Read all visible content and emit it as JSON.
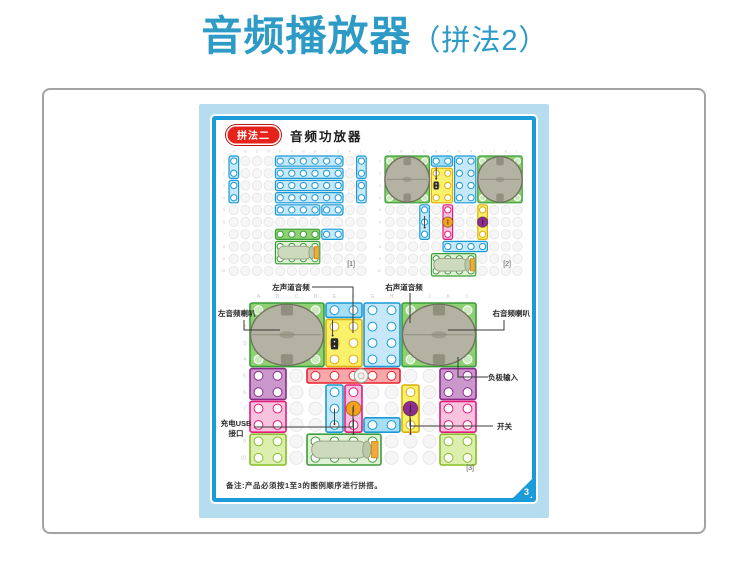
{
  "header": {
    "title_main": "音频播放器",
    "title_sub": "（拼法2）"
  },
  "page": {
    "badge": "拼法二",
    "title": "音频功放器",
    "note": "备注:产品必须按1至3的图例顺序进行拼搭。",
    "page_number": "3"
  },
  "labels": {
    "left_channel": "左声道音频",
    "right_channel": "右声道音频",
    "left_speaker": "左音频喇叭",
    "right_speaker": "右音频喇叭",
    "negative_input": "负极输入",
    "usb_line1": "充电USB",
    "usb_line2": "接口",
    "switch": "开关"
  },
  "grid_letters": [
    "A",
    "B",
    "C",
    "D",
    "E",
    "F",
    "G",
    "H",
    "I",
    "J",
    "K",
    "L"
  ],
  "grid_numbers": [
    "1",
    "2",
    "3",
    "4",
    "5",
    "6",
    "7",
    "8",
    "9",
    "10"
  ],
  "colors": {
    "title_blue": "#2e9bc6",
    "page_border_blue": "#1b9cd9",
    "page_bg_blue": "#b6dcf0",
    "badge_red": "#e5231b",
    "knob_orange": "#f2a21b",
    "knob_purple": "#8e2d8e"
  },
  "palette": {
    "blue": {
      "f": "#c7e8f8",
      "s": "#1a9ad6"
    },
    "cyan": {
      "f": "#a6def4",
      "s": "#1a9ad6"
    },
    "green": {
      "f": "#8ed072",
      "s": "#3a9e3a"
    },
    "battery": {
      "f": "#e2f1d5",
      "s": "#3a9e3a"
    },
    "lgreen": {
      "f": "#dcefae",
      "s": "#86bd28"
    },
    "yellow": {
      "f": "#f9f06c",
      "s": "#dfae0b"
    },
    "pink": {
      "f": "#f8c3dd",
      "s": "#e8197d"
    },
    "purple": {
      "f": "#cb98cb",
      "s": "#8d278d"
    },
    "red": {
      "f": "#f6a8ac",
      "s": "#e8242c"
    },
    "speaker": {
      "f": "#b3b2a3",
      "s": "#72725f"
    }
  },
  "figures": {
    "fig1": {
      "caption": "[1]",
      "bricks": [
        {
          "x": 0,
          "y": 0,
          "w": 1,
          "h": 2,
          "c": "blue"
        },
        {
          "x": 0,
          "y": 2,
          "w": 1,
          "h": 2,
          "c": "blue"
        },
        {
          "x": 4,
          "y": 0,
          "w": 6,
          "h": 1,
          "c": "blue"
        },
        {
          "x": 4,
          "y": 1,
          "w": 6,
          "h": 1,
          "c": "blue"
        },
        {
          "x": 4,
          "y": 2,
          "w": 6,
          "h": 1,
          "c": "blue"
        },
        {
          "x": 4,
          "y": 3,
          "w": 6,
          "h": 1,
          "c": "blue"
        },
        {
          "x": 4,
          "y": 4,
          "w": 4,
          "h": 1,
          "c": "blue"
        },
        {
          "x": 8,
          "y": 4,
          "w": 2,
          "h": 1,
          "c": "blue"
        },
        {
          "x": 11,
          "y": 0,
          "w": 1,
          "h": 2,
          "c": "blue"
        },
        {
          "x": 11,
          "y": 2,
          "w": 1,
          "h": 2,
          "c": "blue"
        },
        {
          "x": 4,
          "y": 6,
          "w": 4,
          "h": 1,
          "c": "green"
        },
        {
          "x": 8,
          "y": 6,
          "w": 2,
          "h": 1,
          "c": "blue"
        },
        {
          "x": 4,
          "y": 7,
          "w": 4,
          "h": 2,
          "c": "green",
          "type": "battery"
        }
      ],
      "decos": []
    },
    "fig2": {
      "caption": "[2]",
      "bricks": [
        {
          "x": 0,
          "y": 0,
          "w": 4,
          "h": 4,
          "c": "green",
          "type": "speaker"
        },
        {
          "x": 8,
          "y": 0,
          "w": 4,
          "h": 4,
          "c": "green",
          "type": "speaker"
        },
        {
          "x": 4,
          "y": 0,
          "w": 2,
          "h": 1,
          "c": "cyan"
        },
        {
          "x": 6,
          "y": 0,
          "w": 2,
          "h": 4,
          "c": "blue"
        },
        {
          "x": 4,
          "y": 1,
          "w": 2,
          "h": 3,
          "c": "yellow"
        },
        {
          "x": 3,
          "y": 4,
          "w": 1,
          "h": 3,
          "c": "blue"
        },
        {
          "x": 5,
          "y": 4,
          "w": 1,
          "h": 3,
          "c": "pink"
        },
        {
          "x": 5,
          "y": 7,
          "w": 4,
          "h": 1,
          "c": "blue"
        },
        {
          "x": 8,
          "y": 4,
          "w": 1,
          "h": 3,
          "c": "yellow"
        },
        {
          "x": 4,
          "y": 8,
          "w": 4,
          "h": 2,
          "c": "green",
          "type": "battery"
        }
      ],
      "decos": [
        {
          "type": "chip",
          "x": 4.5,
          "y": 2.5
        },
        {
          "type": "wire",
          "x": 4.5,
          "y": 1.5
        },
        {
          "type": "wire",
          "x": 3.5,
          "y": 5.5
        },
        {
          "type": "knob",
          "x": 5.5,
          "y": 5.5,
          "color": "#f2a21b"
        },
        {
          "type": "knob",
          "x": 8.5,
          "y": 5.5,
          "color": "#8e2d8e"
        }
      ]
    },
    "fig3": {
      "caption": "[3]",
      "bricks": [
        {
          "x": 0,
          "y": 0,
          "w": 4,
          "h": 4,
          "c": "green",
          "type": "speaker"
        },
        {
          "x": 8,
          "y": 0,
          "w": 4,
          "h": 4,
          "c": "green",
          "type": "speaker"
        },
        {
          "x": 4,
          "y": 0,
          "w": 2,
          "h": 1,
          "c": "cyan"
        },
        {
          "x": 6,
          "y": 0,
          "w": 2,
          "h": 4,
          "c": "blue"
        },
        {
          "x": 4,
          "y": 1,
          "w": 2,
          "h": 3,
          "c": "yellow"
        },
        {
          "x": 0,
          "y": 4,
          "w": 2,
          "h": 2,
          "c": "purple"
        },
        {
          "x": 10,
          "y": 4,
          "w": 2,
          "h": 2,
          "c": "purple"
        },
        {
          "x": 3,
          "y": 4,
          "w": 5,
          "h": 1,
          "c": "red"
        },
        {
          "x": 0,
          "y": 6,
          "w": 2,
          "h": 2,
          "c": "pink"
        },
        {
          "x": 10,
          "y": 6,
          "w": 2,
          "h": 2,
          "c": "pink"
        },
        {
          "x": 4,
          "y": 5,
          "w": 1,
          "h": 3,
          "c": "blue"
        },
        {
          "x": 5,
          "y": 5,
          "w": 1,
          "h": 3,
          "c": "pink"
        },
        {
          "x": 6,
          "y": 7,
          "w": 2,
          "h": 1,
          "c": "cyan"
        },
        {
          "x": 8,
          "y": 5,
          "w": 1,
          "h": 3,
          "c": "yellow"
        },
        {
          "x": 0,
          "y": 8,
          "w": 2,
          "h": 2,
          "c": "lgreen"
        },
        {
          "x": 10,
          "y": 8,
          "w": 2,
          "h": 2,
          "c": "lgreen"
        },
        {
          "x": 3,
          "y": 8,
          "w": 4,
          "h": 2,
          "c": "green",
          "type": "battery"
        }
      ],
      "decos": [
        {
          "type": "chip",
          "x": 4.5,
          "y": 2.55
        },
        {
          "type": "wire",
          "x": 4.4,
          "y": 1.6
        },
        {
          "type": "disc",
          "x": 5.9,
          "y": 4.5
        },
        {
          "type": "knob",
          "x": 5.5,
          "y": 6.5,
          "color": "#f2a21b"
        },
        {
          "type": "knob",
          "x": 8.5,
          "y": 6.5,
          "color": "#8e2d8e"
        },
        {
          "type": "wire",
          "x": 4.5,
          "y": 7.0
        },
        {
          "type": "wire",
          "x": 5.5,
          "y": 7.6
        },
        {
          "type": "wire",
          "x": 8.5,
          "y": 7.6
        }
      ]
    }
  }
}
